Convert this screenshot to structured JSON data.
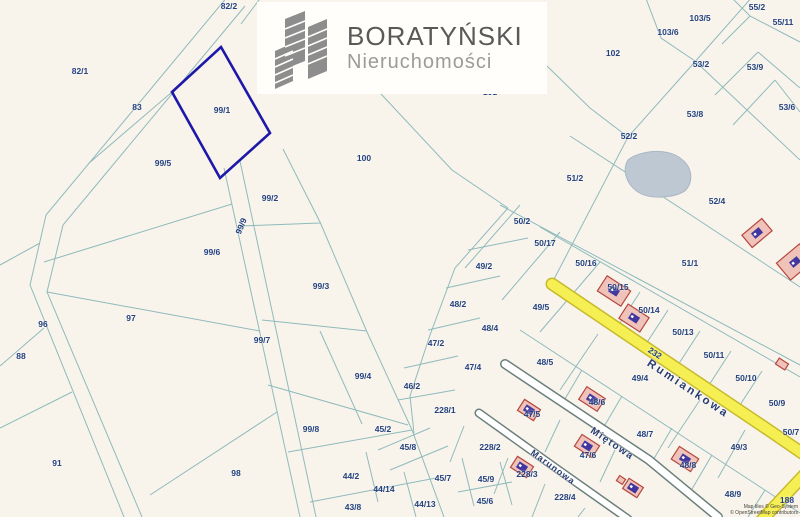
{
  "logo": {
    "title": "BORATYŃSKI",
    "subtitle": "Nieruchomości",
    "icon": "buildings-icon"
  },
  "attribution": {
    "line1": "Map tiles © Geo-System",
    "line2": "© OpenStreetMap contributors"
  },
  "map": {
    "highlighted_parcel": "99/1",
    "colors": {
      "background": "#f8f4ec",
      "boundary_line": "#8fbabc",
      "label": "#24417e",
      "highlight": "#1c18a8",
      "road_yellow": "#f6ef54",
      "road_yellow_edge": "#c6ba2b",
      "road_white": "#ffffff",
      "road_white_edge": "#6b7f7c",
      "pond": "#bdc8d3",
      "building_fill": "#f0c3ba",
      "building_stroke": "#b5463c",
      "building_glyph": "#41379e",
      "logo_gray": "#8d8d8d"
    },
    "streets": [
      {
        "name": "Rumiankowa",
        "x": 688,
        "y": 389,
        "rot": 33.5,
        "font_size": 11.5,
        "letter_spacing": 2.5
      },
      {
        "name": "Miętowa",
        "x": 612,
        "y": 444,
        "rot": 34,
        "font_size": 10,
        "letter_spacing": 1.5
      },
      {
        "name": "Marunowa",
        "x": 553,
        "y": 467,
        "rot": 36,
        "font_size": 9,
        "letter_spacing": 1
      }
    ],
    "parcels": [
      {
        "label": "82/2",
        "x": 229,
        "y": 6
      },
      {
        "label": "82/1",
        "x": 80,
        "y": 71
      },
      {
        "label": "83",
        "x": 137,
        "y": 107
      },
      {
        "label": "99/1",
        "x": 222,
        "y": 110
      },
      {
        "label": "99/5",
        "x": 163,
        "y": 163
      },
      {
        "label": "100",
        "x": 364,
        "y": 158
      },
      {
        "label": "99/2",
        "x": 270,
        "y": 198
      },
      {
        "label": "99/9",
        "x": 241,
        "y": 226,
        "rot": -68
      },
      {
        "label": "99/6",
        "x": 212,
        "y": 252
      },
      {
        "label": "99/3",
        "x": 321,
        "y": 286
      },
      {
        "label": "96",
        "x": 43,
        "y": 324
      },
      {
        "label": "97",
        "x": 131,
        "y": 318
      },
      {
        "label": "88",
        "x": 21,
        "y": 356
      },
      {
        "label": "99/7",
        "x": 262,
        "y": 340
      },
      {
        "label": "99/4",
        "x": 363,
        "y": 376
      },
      {
        "label": "99/8",
        "x": 311,
        "y": 429
      },
      {
        "label": "91",
        "x": 57,
        "y": 463
      },
      {
        "label": "98",
        "x": 236,
        "y": 473
      },
      {
        "label": "101",
        "x": 490,
        "y": 92
      },
      {
        "label": "102",
        "x": 613,
        "y": 53
      },
      {
        "label": "103/5",
        "x": 700,
        "y": 18
      },
      {
        "label": "103/6",
        "x": 668,
        "y": 32
      },
      {
        "label": "55/2",
        "x": 757,
        "y": 7
      },
      {
        "label": "55/11",
        "x": 783,
        "y": 22
      },
      {
        "label": "53/2",
        "x": 701,
        "y": 64
      },
      {
        "label": "53/9",
        "x": 755,
        "y": 67
      },
      {
        "label": "53/6",
        "x": 787,
        "y": 107
      },
      {
        "label": "53/8",
        "x": 695,
        "y": 114
      },
      {
        "label": "52/2",
        "x": 629,
        "y": 136
      },
      {
        "label": "51/2",
        "x": 575,
        "y": 178
      },
      {
        "label": "52/4",
        "x": 717,
        "y": 201
      },
      {
        "label": "50/2",
        "x": 522,
        "y": 221
      },
      {
        "label": "50/17",
        "x": 545,
        "y": 243
      },
      {
        "label": "50/16",
        "x": 586,
        "y": 263
      },
      {
        "label": "51/1",
        "x": 690,
        "y": 263
      },
      {
        "label": "49/2",
        "x": 484,
        "y": 266
      },
      {
        "label": "50/15",
        "x": 618,
        "y": 287
      },
      {
        "label": "48/2",
        "x": 458,
        "y": 304
      },
      {
        "label": "49/5",
        "x": 541,
        "y": 307
      },
      {
        "label": "50/14",
        "x": 649,
        "y": 310
      },
      {
        "label": "48/4",
        "x": 490,
        "y": 328
      },
      {
        "label": "50/13",
        "x": 683,
        "y": 332
      },
      {
        "label": "47/2",
        "x": 436,
        "y": 343
      },
      {
        "label": "232",
        "x": 655,
        "y": 353,
        "rot": 33.5
      },
      {
        "label": "50/11",
        "x": 714,
        "y": 355
      },
      {
        "label": "48/5",
        "x": 545,
        "y": 362
      },
      {
        "label": "47/4",
        "x": 473,
        "y": 367
      },
      {
        "label": "49/4",
        "x": 640,
        "y": 378
      },
      {
        "label": "50/10",
        "x": 746,
        "y": 378
      },
      {
        "label": "46/2",
        "x": 412,
        "y": 386
      },
      {
        "label": "48/6",
        "x": 597,
        "y": 402
      },
      {
        "label": "50/9",
        "x": 777,
        "y": 403
      },
      {
        "label": "228/1",
        "x": 445,
        "y": 410
      },
      {
        "label": "47/5",
        "x": 532,
        "y": 414
      },
      {
        "label": "45/2",
        "x": 383,
        "y": 429
      },
      {
        "label": "50/7",
        "x": 791,
        "y": 432
      },
      {
        "label": "48/7",
        "x": 645,
        "y": 434
      },
      {
        "label": "228/2",
        "x": 490,
        "y": 447
      },
      {
        "label": "45/8",
        "x": 408,
        "y": 447
      },
      {
        "label": "49/3",
        "x": 739,
        "y": 447
      },
      {
        "label": "47/6",
        "x": 588,
        "y": 455
      },
      {
        "label": "48/8",
        "x": 688,
        "y": 465
      },
      {
        "label": "228/3",
        "x": 527,
        "y": 474
      },
      {
        "label": "44/2",
        "x": 351,
        "y": 476
      },
      {
        "label": "45/7",
        "x": 443,
        "y": 478
      },
      {
        "label": "45/9",
        "x": 486,
        "y": 479
      },
      {
        "label": "44/14",
        "x": 384,
        "y": 489
      },
      {
        "label": "48/9",
        "x": 733,
        "y": 494
      },
      {
        "label": "228/4",
        "x": 565,
        "y": 497
      },
      {
        "label": "188",
        "x": 787,
        "y": 500
      },
      {
        "label": "45/6",
        "x": 485,
        "y": 501
      },
      {
        "label": "44/13",
        "x": 425,
        "y": 504
      },
      {
        "label": "43/8",
        "x": 353,
        "y": 507
      }
    ],
    "buildings": [
      {
        "x": 757,
        "y": 233,
        "w": 26,
        "h": 16,
        "rot": -40,
        "glyph": true
      },
      {
        "x": 795,
        "y": 262,
        "w": 30,
        "h": 22,
        "rot": -40,
        "glyph": true
      },
      {
        "x": 614,
        "y": 291,
        "w": 28,
        "h": 18,
        "rot": 33,
        "glyph": true
      },
      {
        "x": 634,
        "y": 318,
        "w": 25,
        "h": 17,
        "rot": 33,
        "glyph": true
      },
      {
        "x": 592,
        "y": 399,
        "w": 22,
        "h": 15,
        "rot": 33,
        "glyph": true
      },
      {
        "x": 529,
        "y": 410,
        "w": 19,
        "h": 13,
        "rot": 33,
        "glyph": true
      },
      {
        "x": 587,
        "y": 446,
        "w": 21,
        "h": 14,
        "rot": 33,
        "glyph": true
      },
      {
        "x": 685,
        "y": 459,
        "w": 23,
        "h": 15,
        "rot": 33,
        "glyph": true
      },
      {
        "x": 522,
        "y": 467,
        "w": 19,
        "h": 13,
        "rot": 33,
        "glyph": true
      },
      {
        "x": 633,
        "y": 488,
        "w": 17,
        "h": 12,
        "rot": 33,
        "glyph": true
      },
      {
        "x": 782,
        "y": 364,
        "w": 11,
        "h": 7,
        "rot": 33,
        "glyph": false
      },
      {
        "x": 621,
        "y": 480,
        "w": 7,
        "h": 6,
        "rot": 33,
        "glyph": false
      }
    ]
  }
}
